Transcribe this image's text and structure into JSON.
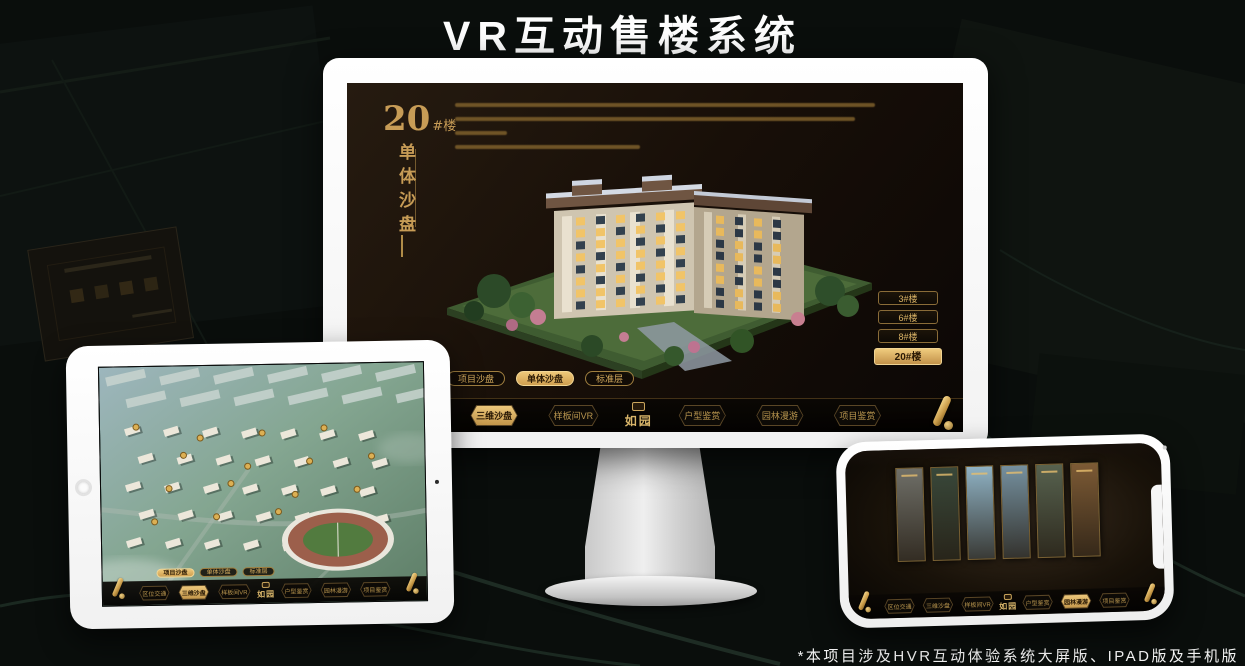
{
  "page": {
    "title": "VR互动售楼系统",
    "footnote": "*本项目涉及HVR互动体验系统大屏版、IPAD版及手机版"
  },
  "colors": {
    "gold": "#c79c56",
    "gold_bright": "#ecc77b",
    "active_text": "#2b1a05",
    "screen_bg": "#180f08",
    "page_bg": "#0a0e0c"
  },
  "brand": {
    "logo": "如园"
  },
  "sub_tabs": {
    "items": [
      "项目沙盘",
      "单体沙盘",
      "标准层"
    ]
  },
  "menu": {
    "items": [
      "区位交通",
      "三维沙盘",
      "样板间VR",
      "户型鉴赏",
      "园林漫游",
      "项目鉴赏"
    ]
  },
  "monitor": {
    "block_number": "20",
    "block_suffix": "#楼",
    "vertical_title": "单体沙盘",
    "buttons": [
      "3#楼",
      "6#楼",
      "8#楼",
      "20#楼"
    ],
    "buttons_active_index": 3,
    "sub_tabs_active_index": 1,
    "menu_active_index": 1
  },
  "ipad": {
    "sub_tabs_active_index": 0,
    "menu_active_index": 1
  },
  "phone": {
    "menu_active_index": 4,
    "gallery": [
      {
        "name": "panel-interior-grey",
        "tint": "#6f6f68"
      },
      {
        "name": "panel-courtyard",
        "tint": "#39483a"
      },
      {
        "name": "panel-garden-sky",
        "tint": "#8fb2c4"
      },
      {
        "name": "panel-building-blue",
        "tint": "#75909f"
      },
      {
        "name": "panel-street",
        "tint": "#57624f"
      },
      {
        "name": "panel-clubhouse-warm",
        "tint": "#7c5a35"
      }
    ]
  }
}
